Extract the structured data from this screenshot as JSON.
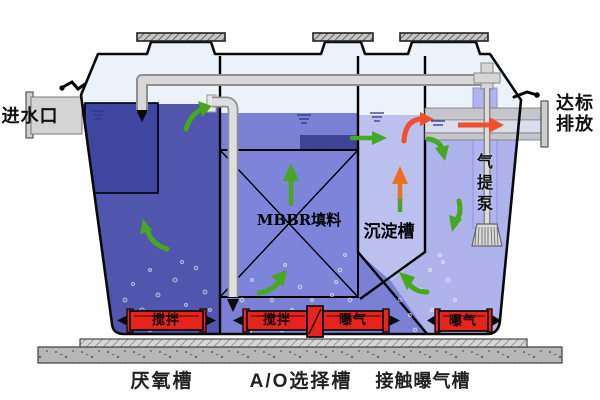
{
  "labels": {
    "inlet": "进水口",
    "discharge": [
      "达标",
      "排放"
    ],
    "mbbr": "MBBR填料",
    "sedimentation": "沉淀槽",
    "airlift": [
      "气",
      "提",
      "泵"
    ],
    "zones": [
      "厌氧槽",
      "A/O选择槽",
      "接触曝气槽"
    ],
    "devices": {
      "stir": "搅拌",
      "aerate": "曝气"
    }
  },
  "colors": {
    "anaerobic_water": "#5056ae",
    "baffle_box": "#3e46a0",
    "ao_water": "#7a81d4",
    "mbbr_box": "#7d84da",
    "sed_water": "#bcc0ee",
    "contact_water": "#aeb3ec",
    "tank_air": "#ecf2fa",
    "device_red": "#e6241c",
    "green_arrow": "#45a81e",
    "orange_arrow": "#e8731e",
    "red_arrow": "#f0502e",
    "pipe_gray": "#d8d8d8"
  }
}
